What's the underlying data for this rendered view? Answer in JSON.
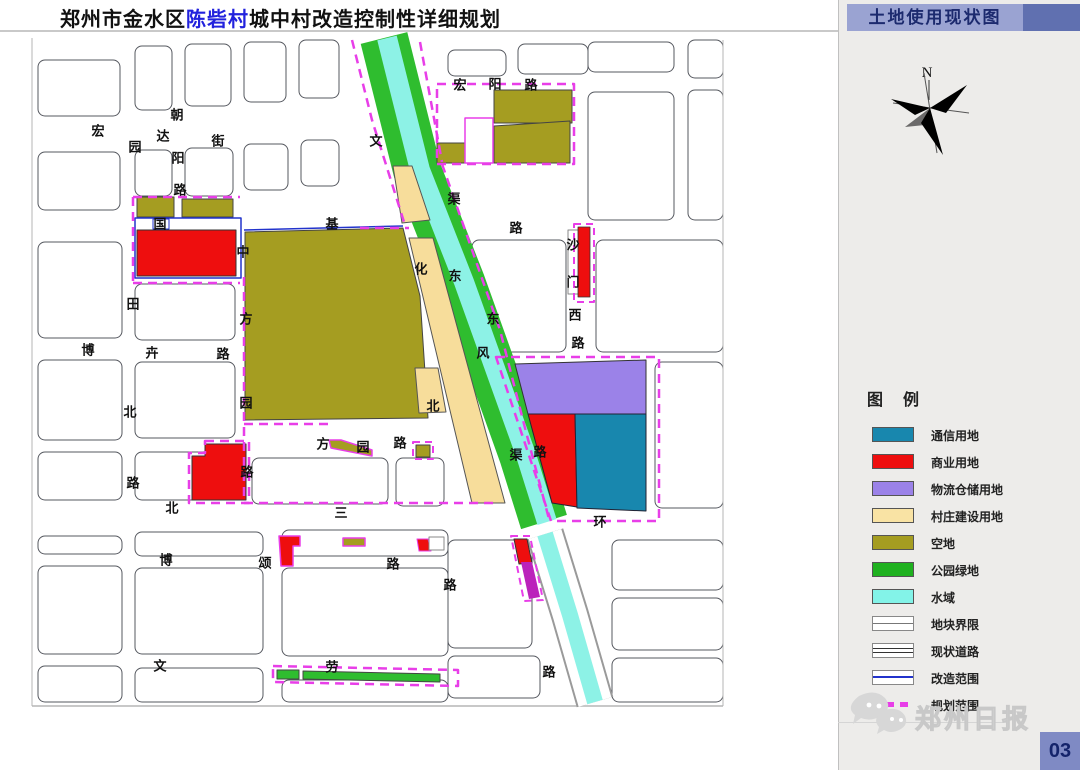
{
  "title": {
    "part1": "郑州市金水区",
    "highlight": "陈砦村",
    "part2": "城中村改造控制性详细规划"
  },
  "panel": {
    "header": "土地使用现状图",
    "compass_label": "N",
    "legend_title": "图　例",
    "legend": [
      {
        "label": "通信用地",
        "swatch": "fill",
        "color": "#1887ae"
      },
      {
        "label": "商业用地",
        "swatch": "fill",
        "color": "#ee0e0e"
      },
      {
        "label": "物流仓储用地",
        "swatch": "fill",
        "color": "#9b82e8"
      },
      {
        "label": "村庄建设用地",
        "swatch": "fill",
        "color": "#f9e3a4"
      },
      {
        "label": "空地",
        "swatch": "fill",
        "color": "#a59d21"
      },
      {
        "label": "公园绿地",
        "swatch": "fill",
        "color": "#1fb11f"
      },
      {
        "label": "水域",
        "swatch": "fill",
        "color": "#83f3e8"
      },
      {
        "label": "地块界限",
        "swatch": "line-single",
        "color": "#777777"
      },
      {
        "label": "现状道路",
        "swatch": "line-double",
        "color": "#333333"
      },
      {
        "label": "改造范围",
        "swatch": "line-solid",
        "color": "#2233cc"
      },
      {
        "label": "规划范围",
        "swatch": "line-dashed",
        "color": "#e83ee8"
      }
    ],
    "brand": "郑州日报",
    "page_number": "03"
  },
  "map": {
    "road_names": [
      "宏达街",
      "朝阳路",
      "国基路",
      "中方园路",
      "博卉路",
      "文化北路",
      "渠东路",
      "东风渠",
      "沙门西路",
      "宏阳路",
      "方园路",
      "北三环",
      "博颂路",
      "文劳路"
    ],
    "labels": [
      {
        "t": "宏",
        "x": 98,
        "y": 131
      },
      {
        "t": "达",
        "x": 163,
        "y": 136
      },
      {
        "t": "街",
        "x": 218,
        "y": 141
      },
      {
        "t": "朝",
        "x": 177,
        "y": 115
      },
      {
        "t": "阳",
        "x": 178,
        "y": 158
      },
      {
        "t": "路",
        "x": 180,
        "y": 190
      },
      {
        "t": "园",
        "x": 135,
        "y": 147
      },
      {
        "t": "国",
        "x": 160,
        "y": 224
      },
      {
        "t": "基",
        "x": 332,
        "y": 224
      },
      {
        "t": "路",
        "x": 516,
        "y": 228
      },
      {
        "t": "中",
        "x": 243,
        "y": 252
      },
      {
        "t": "方",
        "x": 246,
        "y": 319
      },
      {
        "t": "园",
        "x": 246,
        "y": 403
      },
      {
        "t": "路",
        "x": 247,
        "y": 472
      },
      {
        "t": "田",
        "x": 133,
        "y": 304
      },
      {
        "t": "北",
        "x": 130,
        "y": 412
      },
      {
        "t": "路",
        "x": 133,
        "y": 483
      },
      {
        "t": "博",
        "x": 88,
        "y": 350
      },
      {
        "t": "卉",
        "x": 152,
        "y": 353
      },
      {
        "t": "路",
        "x": 223,
        "y": 354
      },
      {
        "t": "文",
        "x": 376,
        "y": 141
      },
      {
        "t": "化",
        "x": 421,
        "y": 269
      },
      {
        "t": "北",
        "x": 433,
        "y": 406
      },
      {
        "t": "渠",
        "x": 454,
        "y": 199
      },
      {
        "t": "东",
        "x": 493,
        "y": 319
      },
      {
        "t": "路",
        "x": 540,
        "y": 452
      },
      {
        "t": "东",
        "x": 455,
        "y": 276
      },
      {
        "t": "风",
        "x": 483,
        "y": 353
      },
      {
        "t": "渠",
        "x": 516,
        "y": 455
      },
      {
        "t": "沙",
        "x": 573,
        "y": 245
      },
      {
        "t": "门",
        "x": 573,
        "y": 282
      },
      {
        "t": "西",
        "x": 575,
        "y": 315
      },
      {
        "t": "路",
        "x": 578,
        "y": 343
      },
      {
        "t": "宏",
        "x": 460,
        "y": 85
      },
      {
        "t": "阳",
        "x": 495,
        "y": 84
      },
      {
        "t": "路",
        "x": 531,
        "y": 85
      },
      {
        "t": "方",
        "x": 323,
        "y": 444
      },
      {
        "t": "园",
        "x": 363,
        "y": 447
      },
      {
        "t": "路",
        "x": 400,
        "y": 443
      },
      {
        "t": "北",
        "x": 172,
        "y": 508
      },
      {
        "t": "三",
        "x": 341,
        "y": 513
      },
      {
        "t": "环",
        "x": 600,
        "y": 522
      },
      {
        "t": "博",
        "x": 166,
        "y": 560
      },
      {
        "t": "颂",
        "x": 265,
        "y": 563
      },
      {
        "t": "路",
        "x": 393,
        "y": 564
      },
      {
        "t": "文",
        "x": 160,
        "y": 666
      },
      {
        "t": "劳",
        "x": 332,
        "y": 667
      },
      {
        "t": "路",
        "x": 549,
        "y": 672
      },
      {
        "t": "路",
        "x": 450,
        "y": 585
      }
    ],
    "parcels": [
      [
        38,
        60,
        82,
        56
      ],
      [
        135,
        46,
        37,
        64
      ],
      [
        185,
        44,
        46,
        62
      ],
      [
        244,
        42,
        42,
        60
      ],
      [
        299,
        40,
        40,
        58
      ],
      [
        38,
        152,
        82,
        58
      ],
      [
        135,
        150,
        37,
        46
      ],
      [
        185,
        148,
        48,
        48
      ],
      [
        244,
        144,
        44,
        46
      ],
      [
        301,
        140,
        38,
        46
      ],
      [
        38,
        242,
        84,
        96
      ],
      [
        135,
        284,
        100,
        56
      ],
      [
        38,
        360,
        84,
        80
      ],
      [
        135,
        362,
        100,
        76
      ],
      [
        38,
        452,
        84,
        48
      ],
      [
        135,
        452,
        100,
        48
      ],
      [
        252,
        458,
        136,
        46
      ],
      [
        396,
        458,
        48,
        48
      ],
      [
        38,
        536,
        84,
        18
      ],
      [
        135,
        532,
        128,
        24
      ],
      [
        282,
        530,
        166,
        26
      ],
      [
        38,
        566,
        84,
        88
      ],
      [
        135,
        568,
        128,
        86
      ],
      [
        282,
        568,
        166,
        88
      ],
      [
        38,
        666,
        84,
        36
      ],
      [
        135,
        668,
        128,
        34
      ],
      [
        282,
        680,
        166,
        22
      ],
      [
        448,
        50,
        58,
        26
      ],
      [
        518,
        44,
        70,
        30
      ],
      [
        588,
        42,
        86,
        30
      ],
      [
        688,
        40,
        35,
        38
      ],
      [
        588,
        92,
        86,
        128
      ],
      [
        688,
        90,
        35,
        130
      ],
      [
        596,
        240,
        127,
        112
      ],
      [
        472,
        240,
        94,
        112
      ],
      [
        655,
        362,
        68,
        146
      ],
      [
        612,
        540,
        111,
        50
      ],
      [
        612,
        598,
        111,
        52
      ],
      [
        612,
        658,
        111,
        44
      ],
      [
        448,
        540,
        84,
        108
      ],
      [
        448,
        656,
        92,
        42
      ]
    ],
    "shapes": [
      {
        "d": "M32,38 V706",
        "s": "#b5b5b5",
        "w": 1
      },
      {
        "d": "M723,40 V706",
        "s": "#b5b5b5",
        "w": 1
      },
      {
        "d": "M32,706 H723",
        "s": "#b5b5b5",
        "w": 1.5
      },
      {
        "d": "M384,38 L417,170 L461,282 L523,455 L544,522",
        "s": "#2fbd2f",
        "w": 48
      },
      {
        "d": "M387,38 L420,170 L464,282 L526,455 L547,522",
        "s": "#8df2e6",
        "w": 20
      },
      {
        "d": "M545,534 L570,615 L595,702",
        "s": "#9a9a9a",
        "w": 38
      },
      {
        "d": "M545,534 L570,615 L595,702",
        "s": "#ffffff",
        "w": 34
      },
      {
        "d": "M545,534 L570,615 L595,702",
        "s": "#8df2e6",
        "w": 16
      },
      {
        "d": "M137,197 H174 V217 H137 Z",
        "f": "#a59d21",
        "s": "#444",
        "w": 1
      },
      {
        "d": "M182,199 H233 V217 H182 Z",
        "f": "#a59d21",
        "s": "#444",
        "w": 1
      },
      {
        "d": "M153,219 H169 V229 H153 Z",
        "f": "#ffffff",
        "s": "#2233cc",
        "w": 1
      },
      {
        "d": "M137,230 H236 V276 H137 Z",
        "f": "#ee0e0e",
        "s": "#333",
        "w": 1
      },
      {
        "d": "M245,232 L403,228 L420,296 L428,418 L245,420 Z",
        "f": "#a59d21",
        "s": "#444",
        "w": 1
      },
      {
        "d": "M393,166 L412,166 L430,220 L402,223 Z",
        "f": "#f7dd9b",
        "s": "#555",
        "w": 1
      },
      {
        "d": "M409,238 L433,238 L505,503 L472,503 Z",
        "f": "#f7dd9b",
        "s": "#555",
        "w": 1
      },
      {
        "d": "M415,368 L438,368 L446,412 L419,413 Z",
        "f": "#f7dd9b",
        "s": "#555",
        "w": 1
      },
      {
        "d": "M494,90 H572 V123 H494 Z",
        "f": "#a59d21",
        "s": "#444",
        "w": 1
      },
      {
        "d": "M494,126 L570,121 L570,163 L494,163 Z",
        "f": "#a59d21",
        "s": "#444",
        "w": 1
      },
      {
        "d": "M437,143 H465 V163 H437 Z",
        "f": "#a59d21",
        "s": "#444",
        "w": 1
      },
      {
        "d": "M465,118 H493 V163 H465 Z",
        "f": "#ffffff",
        "s": "#e83ee8",
        "w": 1.5
      },
      {
        "d": "M515,364 L646,360 L646,414 L528,414 Z",
        "f": "#9b82e8",
        "s": "#333",
        "w": 1
      },
      {
        "d": "M528,414 L575,414 L577,507 L552,503 Z",
        "f": "#ee0e0e",
        "s": "#223",
        "w": 1
      },
      {
        "d": "M575,414 L646,414 L646,511 L577,508 Z",
        "f": "#1887ae",
        "s": "#223",
        "w": 1
      },
      {
        "d": "M568,230 H580 V294 H568 Z",
        "f": "#ffffff",
        "s": "#888",
        "w": 1
      },
      {
        "d": "M578,227 H590 V297 H578 Z",
        "f": "#ee0e0e",
        "s": "#333",
        "w": 0.8
      },
      {
        "d": "M205,444 L246,444 L246,500 L192,500 L192,456 L205,456 Z",
        "f": "#ee0e0e",
        "s": "#333",
        "w": 1
      },
      {
        "d": "M279,536 L300,536 L300,546 L293,546 L293,566 L281,566 Z",
        "f": "#ee0e0e",
        "s": "#e83ee8",
        "w": 1.5
      },
      {
        "d": "M343,538 H365 V546 H343 Z",
        "f": "#a59d21",
        "s": "#e83ee8",
        "w": 1.5
      },
      {
        "d": "M417,539 L428,539 L431,551 L419,551 Z",
        "f": "#ee0e0e",
        "s": "#e83ee8",
        "w": 1
      },
      {
        "d": "M429,537 H444 V550 H429 Z",
        "f": "#ffffff",
        "s": "#888",
        "w": 1
      },
      {
        "d": "M329,440 L341,440 L372,450 L372,456 L331,448 Z",
        "f": "#a59d21",
        "s": "#e83ee8",
        "w": 1.5
      },
      {
        "d": "M416,445 H430 V457 H416 Z",
        "f": "#a59d21",
        "s": "#444",
        "w": 1
      },
      {
        "d": "M277,670 H299 V679 H277 Z",
        "f": "#2fbd2f",
        "s": "#444",
        "w": 1
      },
      {
        "d": "M303,671 L440,674 L440,682 L303,679 Z",
        "f": "#2fbd2f",
        "s": "#444",
        "w": 1
      },
      {
        "d": "M514,539 L527,539 L532,563 L519,564 Z",
        "f": "#ee0e0e",
        "s": "#333",
        "w": 1
      },
      {
        "d": "M521,562 L532,562 L540,597 L529,599 Z",
        "f": "#bb22bb"
      },
      {
        "d": "M135,218 H241 V278 H135 Z",
        "s": "#2233cc",
        "w": 1.5
      },
      {
        "d": "M244,230 L403,226",
        "s": "#2233cc",
        "w": 1.5
      },
      {
        "d": "M133,197 H240",
        "s": "#e83ee8",
        "w": 2.5,
        "da": "9 6"
      },
      {
        "d": "M133,197 V283",
        "s": "#e83ee8",
        "w": 2.5,
        "da": "9 6"
      },
      {
        "d": "M133,283 H240",
        "s": "#e83ee8",
        "w": 2.5,
        "da": "9 6"
      },
      {
        "d": "M244,277 V503",
        "s": "#e83ee8",
        "w": 2.5,
        "da": "9 6"
      },
      {
        "d": "M244,503 H496",
        "s": "#e83ee8",
        "w": 2.5,
        "da": "9 6"
      },
      {
        "d": "M244,424 H333",
        "s": "#e83ee8",
        "w": 2.5,
        "da": "9 6"
      },
      {
        "d": "M352,40 L372,120 L404,222",
        "s": "#e83ee8",
        "w": 2.5,
        "da": "9 6"
      },
      {
        "d": "M360,228 H409",
        "s": "#e83ee8",
        "w": 2.5,
        "da": "9 6"
      },
      {
        "d": "M420,42 L442,162",
        "s": "#e83ee8",
        "w": 2.5,
        "da": "9 6"
      },
      {
        "d": "M437,84 H574 V164 H437 Z",
        "s": "#e83ee8",
        "w": 2.5,
        "da": "9 6"
      },
      {
        "d": "M442,164 L500,330 L525,428 L549,519",
        "s": "#e83ee8",
        "w": 2.5,
        "da": "9 6"
      },
      {
        "d": "M496,357 L659,357 L659,521 L551,521 Z",
        "s": "#e83ee8",
        "w": 2.5,
        "da": "9 6"
      },
      {
        "d": "M205,441 L249,441 L249,503 L189,503 L189,453 L205,453 Z",
        "s": "#e83ee8",
        "w": 2.5,
        "da": "9 6"
      },
      {
        "d": "M273,666 L458,670 L458,686 L273,682 Z",
        "s": "#e83ee8",
        "w": 2.5,
        "da": "9 6"
      },
      {
        "d": "M574,224 H594 V302 H574 Z",
        "s": "#e83ee8",
        "w": 2,
        "da": "7 5"
      },
      {
        "d": "M511,536 L530,536 L543,600 L524,601 Z",
        "s": "#e83ee8",
        "w": 2,
        "da": "7 5"
      },
      {
        "d": "M413,442 H433 V459 H413 Z",
        "s": "#e83ee8",
        "w": 2,
        "da": "7 5"
      }
    ]
  }
}
